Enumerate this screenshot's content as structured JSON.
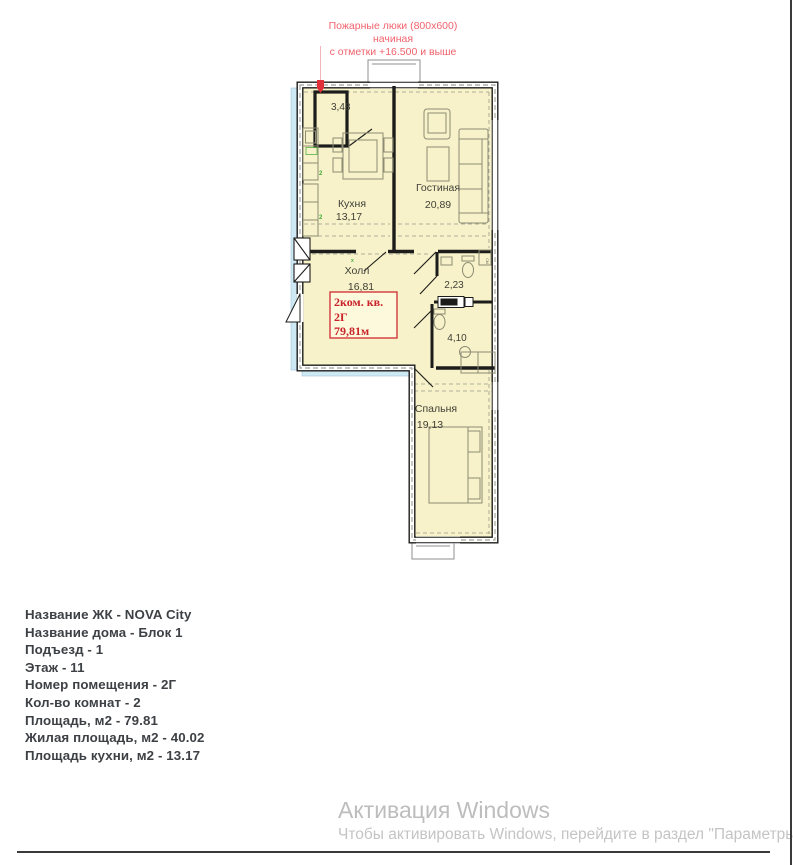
{
  "annotation": {
    "line1": "Пожарные люки (800х600) начиная",
    "line2": "с отметки  +16.500 и выше"
  },
  "plan": {
    "rooms": {
      "storage": {
        "area": "3,48"
      },
      "kitchen": {
        "label": "Кухня",
        "area": "13,17"
      },
      "living": {
        "label": "Гостиная",
        "area": "20,89"
      },
      "hall": {
        "label": "Холл",
        "area": "16,81"
      },
      "wc": {
        "area": "2,23"
      },
      "bathroom": {
        "area": "4,10"
      },
      "bedroom": {
        "label": "Спальня",
        "area": "19,13"
      }
    },
    "unit_box": {
      "type": "2ком. кв.",
      "number": "2Г",
      "area": "79,81м"
    },
    "washer_label": "СМ",
    "outlet_marks": [
      "2",
      "2",
      "х"
    ],
    "colors": {
      "room_fill": "#f7f2c9",
      "glazing": "#cfe9f4",
      "wall": "#1c1c1a",
      "accent_red": "#cf2a32",
      "green": "#3faa35"
    }
  },
  "info": {
    "lines": [
      "Название ЖК - NOVA City",
      "Название дома - Блок 1",
      "Подъезд - 1",
      "Этаж - 11",
      "Номер помещения - 2Г",
      "Кол-во комнат - 2",
      "Площадь, м2 - 79.81",
      "Жилая площадь, м2 - 40.02",
      "Площадь кухни, м2 - 13.17"
    ]
  },
  "watermark": {
    "title": "Активация Windows",
    "subtitle": "Чтобы активировать Windows, перейдите в раздел \"Параметры\""
  }
}
